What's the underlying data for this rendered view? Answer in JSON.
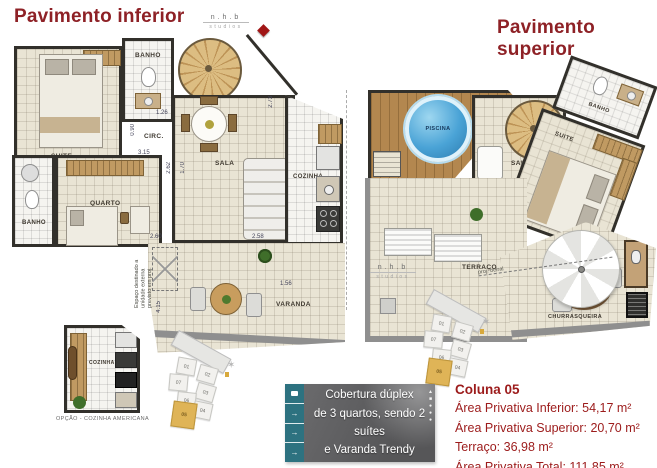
{
  "titles": {
    "inferior": "Pavimento inferior",
    "superior": "Pavimento superior"
  },
  "logo": {
    "name": "n.h.b",
    "sub": "studios"
  },
  "lower_plan": {
    "rooms": {
      "suite": "SUITE",
      "banho1": "BANHO",
      "circ": "CIRC.",
      "sala": "SALA",
      "quarto": "QUARTO",
      "banho2": "BANHO",
      "cozinha": "COZINHA",
      "varanda": "VARANDA"
    },
    "dims": [
      "2.50",
      "1.26",
      "0.90",
      "3.15",
      "2.62",
      "1.70",
      "1.20",
      "2.73",
      "2.58",
      "1.56",
      "4.15",
      "2.60"
    ],
    "ac_note": "Espaço destinado a unidade externa previsto em proj.",
    "option_plan": {
      "label": "OPÇÃO - COZINHA AMERICANA",
      "room": "COZINHA"
    }
  },
  "upper_plan": {
    "rooms": {
      "piscina": "PISCINA",
      "saleta": "SALETA",
      "banho": "BANHO",
      "suite": "SUITE",
      "terraco": "TERRAÇO",
      "churrasqueira": "CHURRASQUEIRA"
    },
    "note": "proj. beiral"
  },
  "key_plan": {
    "units": [
      "01",
      "02",
      "07",
      "03",
      "06",
      "04"
    ],
    "highlighted": "05"
  },
  "banner": {
    "line1": "Cobertura dúplex",
    "line2": "de 3 quartos, sendo 2 suítes",
    "line3": "e Varanda Trendy"
  },
  "info": {
    "title": "Coluna 05",
    "line1": "Área Privativa Inferior: 54,17 m²",
    "line2": "Área Privativa Superior: 20,70 m²",
    "line3": "Terraço: 36,98 m²",
    "line4": "Área Privativa Total: 111,85 m²"
  },
  "colors": {
    "title_red": "#8e2126",
    "info_red": "#9c1b1b",
    "banner_teal": "#2d7280",
    "banner_gray": "#5d5d5f",
    "key_gold": "#dfb457",
    "pool_blue": "#4aa3d6",
    "deck_wood": "#b3874f",
    "floor_beige": "#e9e4d4"
  }
}
